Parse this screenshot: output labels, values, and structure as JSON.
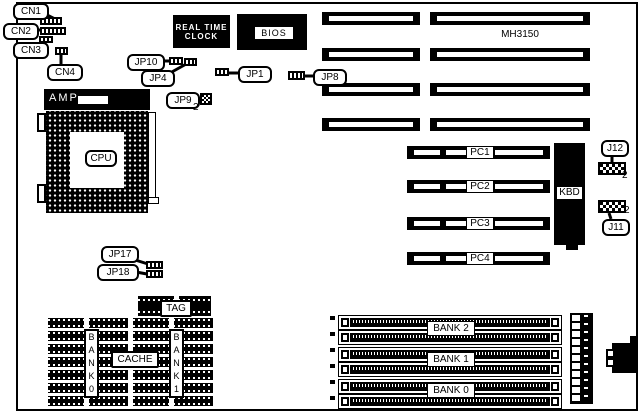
{
  "diagram": {
    "model": "MH3150",
    "pin2": "2",
    "connectors": {
      "cn1": "CN1",
      "cn2": "CN2",
      "cn3": "CN3",
      "cn4": "CN4"
    },
    "jumpers": {
      "jp1": "JP1",
      "jp4": "JP4",
      "jp8": "JP8",
      "jp9": "JP9",
      "jp10": "JP10",
      "jp17": "JP17",
      "jp18": "JP18",
      "j11": "J11",
      "j12": "J12"
    },
    "chips": {
      "rtc_line1": "REAL TIME",
      "rtc_line2": "CLOCK",
      "bios": "BIOS",
      "amp": "AMP",
      "cpu": "CPU",
      "kbd": "KBD"
    },
    "slots": {
      "pc": [
        "PC1",
        "PC2",
        "PC3",
        "PC4"
      ]
    },
    "memory": {
      "banks": [
        "BANK 2",
        "BANK 1",
        "BANK 0"
      ]
    },
    "cache": {
      "tag": "TAG",
      "cache": "CACHE",
      "bank0": "BANK0",
      "bank1": "BANK1"
    }
  }
}
